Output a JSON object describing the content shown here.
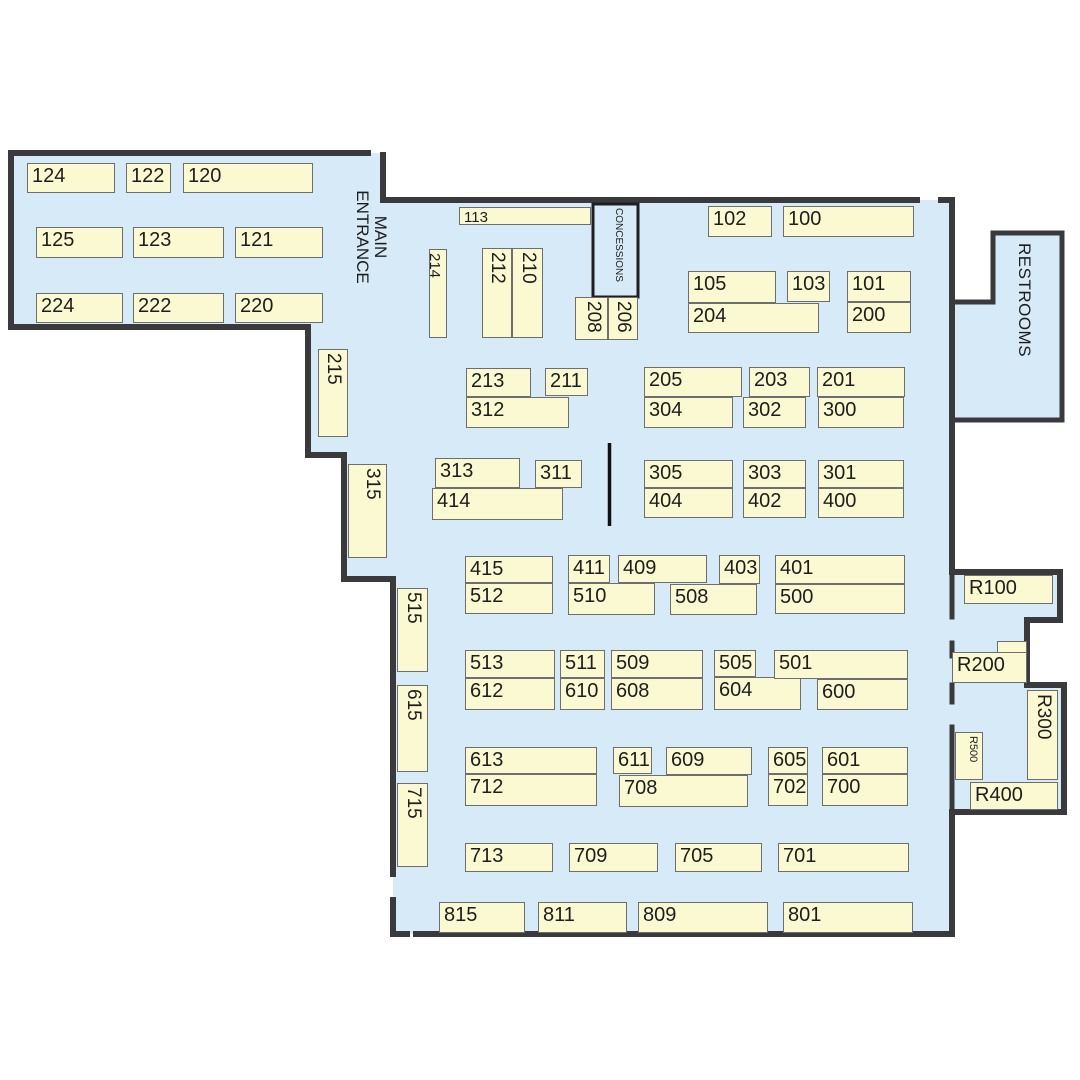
{
  "map": {
    "floor_color": "#d7eaf7",
    "booth_fill": "#fbf9d2",
    "booth_border": "#6e6e6e",
    "wall_color": "#3a3a3c",
    "text_color": "#1d1d1d",
    "outside_color": "#ffffff"
  },
  "areas": {
    "main_entrance": "MAIN ENTRANCE",
    "concessions": "CONCESSIONS",
    "restrooms": "RESTROOMS"
  },
  "booths": [
    {
      "label": "124",
      "x": 27,
      "y": 163,
      "w": 88,
      "h": 30
    },
    {
      "label": "122",
      "x": 126,
      "y": 163,
      "w": 45,
      "h": 30
    },
    {
      "label": "120",
      "x": 183,
      "y": 163,
      "w": 130,
      "h": 30
    },
    {
      "label": "125",
      "x": 36,
      "y": 227,
      "w": 87,
      "h": 31
    },
    {
      "label": "123",
      "x": 133,
      "y": 227,
      "w": 91,
      "h": 31
    },
    {
      "label": "121",
      "x": 235,
      "y": 227,
      "w": 88,
      "h": 31
    },
    {
      "label": "224",
      "x": 36,
      "y": 293,
      "w": 87,
      "h": 30
    },
    {
      "label": "222",
      "x": 133,
      "y": 293,
      "w": 91,
      "h": 30
    },
    {
      "label": "220",
      "x": 235,
      "y": 293,
      "w": 88,
      "h": 30
    },
    {
      "label": "113",
      "x": 459,
      "y": 207,
      "w": 132,
      "h": 18,
      "fs": 15
    },
    {
      "label": "214",
      "x": 429,
      "y": 249,
      "w": 18,
      "h": 89,
      "v": true,
      "fs": 15
    },
    {
      "label": "212",
      "x": 482,
      "y": 248,
      "w": 30,
      "h": 90,
      "v": true
    },
    {
      "label": "210",
      "x": 512,
      "y": 248,
      "w": 31,
      "h": 90,
      "v": true
    },
    {
      "label": "208",
      "x": 575,
      "y": 297,
      "w": 33,
      "h": 43,
      "v": true
    },
    {
      "label": "206",
      "x": 608,
      "y": 297,
      "w": 30,
      "h": 43,
      "v": true
    },
    {
      "label": "102",
      "x": 708,
      "y": 206,
      "w": 64,
      "h": 31
    },
    {
      "label": "100",
      "x": 783,
      "y": 206,
      "w": 131,
      "h": 31
    },
    {
      "label": "105",
      "x": 688,
      "y": 271,
      "w": 88,
      "h": 32
    },
    {
      "label": "103",
      "x": 787,
      "y": 271,
      "w": 43,
      "h": 31
    },
    {
      "label": "101",
      "x": 847,
      "y": 271,
      "w": 64,
      "h": 31
    },
    {
      "label": "204",
      "x": 688,
      "y": 303,
      "w": 131,
      "h": 30
    },
    {
      "label": "200",
      "x": 847,
      "y": 302,
      "w": 64,
      "h": 31
    },
    {
      "label": "215",
      "x": 318,
      "y": 349,
      "w": 30,
      "h": 88,
      "v": true
    },
    {
      "label": "315",
      "x": 348,
      "y": 464,
      "w": 39,
      "h": 94,
      "v": true
    },
    {
      "label": "515",
      "x": 397,
      "y": 588,
      "w": 31,
      "h": 84,
      "v": true
    },
    {
      "label": "615",
      "x": 397,
      "y": 685,
      "w": 31,
      "h": 87,
      "v": true
    },
    {
      "label": "715",
      "x": 397,
      "y": 783,
      "w": 31,
      "h": 84,
      "v": true
    },
    {
      "label": "213",
      "x": 466,
      "y": 368,
      "w": 65,
      "h": 29
    },
    {
      "label": "211",
      "x": 545,
      "y": 368,
      "w": 43,
      "h": 28
    },
    {
      "label": "312",
      "x": 466,
      "y": 397,
      "w": 103,
      "h": 31
    },
    {
      "label": "205",
      "x": 644,
      "y": 367,
      "w": 98,
      "h": 30
    },
    {
      "label": "203",
      "x": 749,
      "y": 367,
      "w": 61,
      "h": 30
    },
    {
      "label": "201",
      "x": 817,
      "y": 367,
      "w": 88,
      "h": 30
    },
    {
      "label": "304",
      "x": 644,
      "y": 397,
      "w": 89,
      "h": 31
    },
    {
      "label": "302",
      "x": 743,
      "y": 397,
      "w": 63,
      "h": 31
    },
    {
      "label": "300",
      "x": 818,
      "y": 397,
      "w": 86,
      "h": 31
    },
    {
      "label": "313",
      "x": 435,
      "y": 458,
      "w": 85,
      "h": 30
    },
    {
      "label": "311",
      "x": 535,
      "y": 460,
      "w": 47,
      "h": 28
    },
    {
      "label": "414",
      "x": 432,
      "y": 488,
      "w": 131,
      "h": 32
    },
    {
      "label": "305",
      "x": 644,
      "y": 460,
      "w": 89,
      "h": 28
    },
    {
      "label": "303",
      "x": 743,
      "y": 460,
      "w": 63,
      "h": 28
    },
    {
      "label": "301",
      "x": 818,
      "y": 460,
      "w": 86,
      "h": 28
    },
    {
      "label": "404",
      "x": 644,
      "y": 488,
      "w": 89,
      "h": 30
    },
    {
      "label": "402",
      "x": 743,
      "y": 488,
      "w": 63,
      "h": 30
    },
    {
      "label": "400",
      "x": 818,
      "y": 488,
      "w": 86,
      "h": 30
    },
    {
      "label": "415",
      "x": 465,
      "y": 556,
      "w": 88,
      "h": 27
    },
    {
      "label": "512",
      "x": 465,
      "y": 583,
      "w": 88,
      "h": 31
    },
    {
      "label": "411",
      "x": 568,
      "y": 555,
      "w": 42,
      "h": 28
    },
    {
      "label": "409",
      "x": 618,
      "y": 555,
      "w": 89,
      "h": 28
    },
    {
      "label": "510",
      "x": 568,
      "y": 583,
      "w": 87,
      "h": 32
    },
    {
      "label": "508",
      "x": 670,
      "y": 584,
      "w": 87,
      "h": 31
    },
    {
      "label": "403",
      "x": 719,
      "y": 555,
      "w": 41,
      "h": 29
    },
    {
      "label": "401",
      "x": 775,
      "y": 555,
      "w": 130,
      "h": 29
    },
    {
      "label": "500",
      "x": 775,
      "y": 584,
      "w": 130,
      "h": 30
    },
    {
      "label": "513",
      "x": 465,
      "y": 650,
      "w": 90,
      "h": 28
    },
    {
      "label": "612",
      "x": 465,
      "y": 678,
      "w": 90,
      "h": 32
    },
    {
      "label": "511",
      "x": 560,
      "y": 650,
      "w": 45,
      "h": 28
    },
    {
      "label": "610",
      "x": 560,
      "y": 678,
      "w": 45,
      "h": 32
    },
    {
      "label": "509",
      "x": 611,
      "y": 650,
      "w": 92,
      "h": 28
    },
    {
      "label": "608",
      "x": 611,
      "y": 678,
      "w": 92,
      "h": 32
    },
    {
      "label": "505",
      "x": 714,
      "y": 650,
      "w": 42,
      "h": 27
    },
    {
      "label": "604",
      "x": 714,
      "y": 677,
      "w": 87,
      "h": 33
    },
    {
      "label": "501",
      "x": 774,
      "y": 650,
      "w": 134,
      "h": 29
    },
    {
      "label": "600",
      "x": 817,
      "y": 679,
      "w": 91,
      "h": 31
    },
    {
      "label": "613",
      "x": 465,
      "y": 747,
      "w": 132,
      "h": 27
    },
    {
      "label": "712",
      "x": 465,
      "y": 774,
      "w": 132,
      "h": 32
    },
    {
      "label": "611",
      "x": 613,
      "y": 747,
      "w": 39,
      "h": 27
    },
    {
      "label": "609",
      "x": 666,
      "y": 747,
      "w": 86,
      "h": 28
    },
    {
      "label": "708",
      "x": 619,
      "y": 775,
      "w": 129,
      "h": 32
    },
    {
      "label": "605",
      "x": 768,
      "y": 747,
      "w": 40,
      "h": 27
    },
    {
      "label": "702",
      "x": 768,
      "y": 774,
      "w": 40,
      "h": 32
    },
    {
      "label": "601",
      "x": 822,
      "y": 747,
      "w": 86,
      "h": 27
    },
    {
      "label": "700",
      "x": 822,
      "y": 774,
      "w": 86,
      "h": 32
    },
    {
      "label": "713",
      "x": 465,
      "y": 843,
      "w": 88,
      "h": 29
    },
    {
      "label": "709",
      "x": 569,
      "y": 843,
      "w": 89,
      "h": 29
    },
    {
      "label": "705",
      "x": 675,
      "y": 843,
      "w": 87,
      "h": 29
    },
    {
      "label": "701",
      "x": 778,
      "y": 843,
      "w": 131,
      "h": 29
    },
    {
      "label": "815",
      "x": 439,
      "y": 902,
      "w": 86,
      "h": 31
    },
    {
      "label": "811",
      "x": 538,
      "y": 902,
      "w": 89,
      "h": 31
    },
    {
      "label": "809",
      "x": 638,
      "y": 902,
      "w": 130,
      "h": 31
    },
    {
      "label": "801",
      "x": 783,
      "y": 902,
      "w": 130,
      "h": 31
    },
    {
      "label": "R100",
      "x": 964,
      "y": 575,
      "w": 89,
      "h": 29
    },
    {
      "label": "",
      "x": 997,
      "y": 641,
      "w": 30,
      "h": 14,
      "name": "r200-ext"
    },
    {
      "label": "R200",
      "x": 952,
      "y": 652,
      "w": 75,
      "h": 31
    },
    {
      "label": "R300",
      "x": 1027,
      "y": 690,
      "w": 31,
      "h": 90,
      "v": true
    },
    {
      "label": "R500",
      "x": 955,
      "y": 732,
      "w": 28,
      "h": 48,
      "v": true,
      "fs": 11
    },
    {
      "label": "R400",
      "x": 970,
      "y": 782,
      "w": 88,
      "h": 28
    }
  ]
}
